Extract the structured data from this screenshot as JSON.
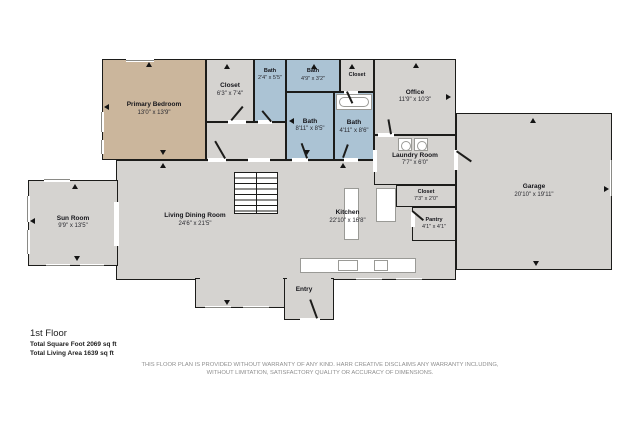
{
  "plan_title": "1st Floor",
  "rooms": {
    "primary_bedroom": {
      "name": "Primary Bedroom",
      "dims": "13'0\" x 13'9\""
    },
    "closet_bedroom": {
      "name": "Closet",
      "dims": "6'3\" x 7'4\""
    },
    "bath_small": {
      "name": "Bath",
      "dims": "2'4\" x 5'5\""
    },
    "bath_top": {
      "name": "Bath",
      "dims": "4'9\" x 3'2\""
    },
    "closet_top": {
      "name": "Closet",
      "dims": ""
    },
    "bath_main": {
      "name": "Bath",
      "dims": "8'11\" x 8'5\""
    },
    "bath_right": {
      "name": "Bath",
      "dims": "4'11\" x 8'6\""
    },
    "office": {
      "name": "Office",
      "dims": "11'9\" x 10'3\""
    },
    "laundry": {
      "name": "Laundry Room",
      "dims": "7'7\" x 6'0\""
    },
    "closet_hall": {
      "name": "Closet",
      "dims": "7'3\" x 2'0\""
    },
    "pantry": {
      "name": "Pantry",
      "dims": "4'1\" x 4'1\""
    },
    "garage": {
      "name": "Garage",
      "dims": "20'10\" x 19'11\""
    },
    "sun_room": {
      "name": "Sun Room",
      "dims": "9'9\" x 13'5\""
    },
    "living": {
      "name": "Living Dining Room",
      "dims": "24'6\" x 21'5\""
    },
    "kitchen": {
      "name": "Kitchen",
      "dims": "22'10\" x 16'8\""
    },
    "entry": {
      "name": "Entry",
      "dims": ""
    }
  },
  "footer": {
    "floor_label": "1st Floor",
    "total_sqft": "Total Square Foot 2069 sq ft",
    "living_area": "Total Living Area 1639 sq ft"
  },
  "disclaimer": {
    "line1": "THIS FLOOR PLAN IS PROVIDED WITHOUT WARRANTY OF ANY KIND. HARR CREATIVE DISCLAIMS ANY WARRANTY INCLUDING,",
    "line2": "WITHOUT LIMITATION, SATISFACTORY QUALITY OR ACCURACY OF DIMENSIONS."
  },
  "colors": {
    "wall": "#1c1c1a",
    "room_gray": "#d5d3d0",
    "room_tan": "#cbb69c",
    "room_blue": "#abc3d4",
    "fixture_outline": "#9a9a96"
  }
}
